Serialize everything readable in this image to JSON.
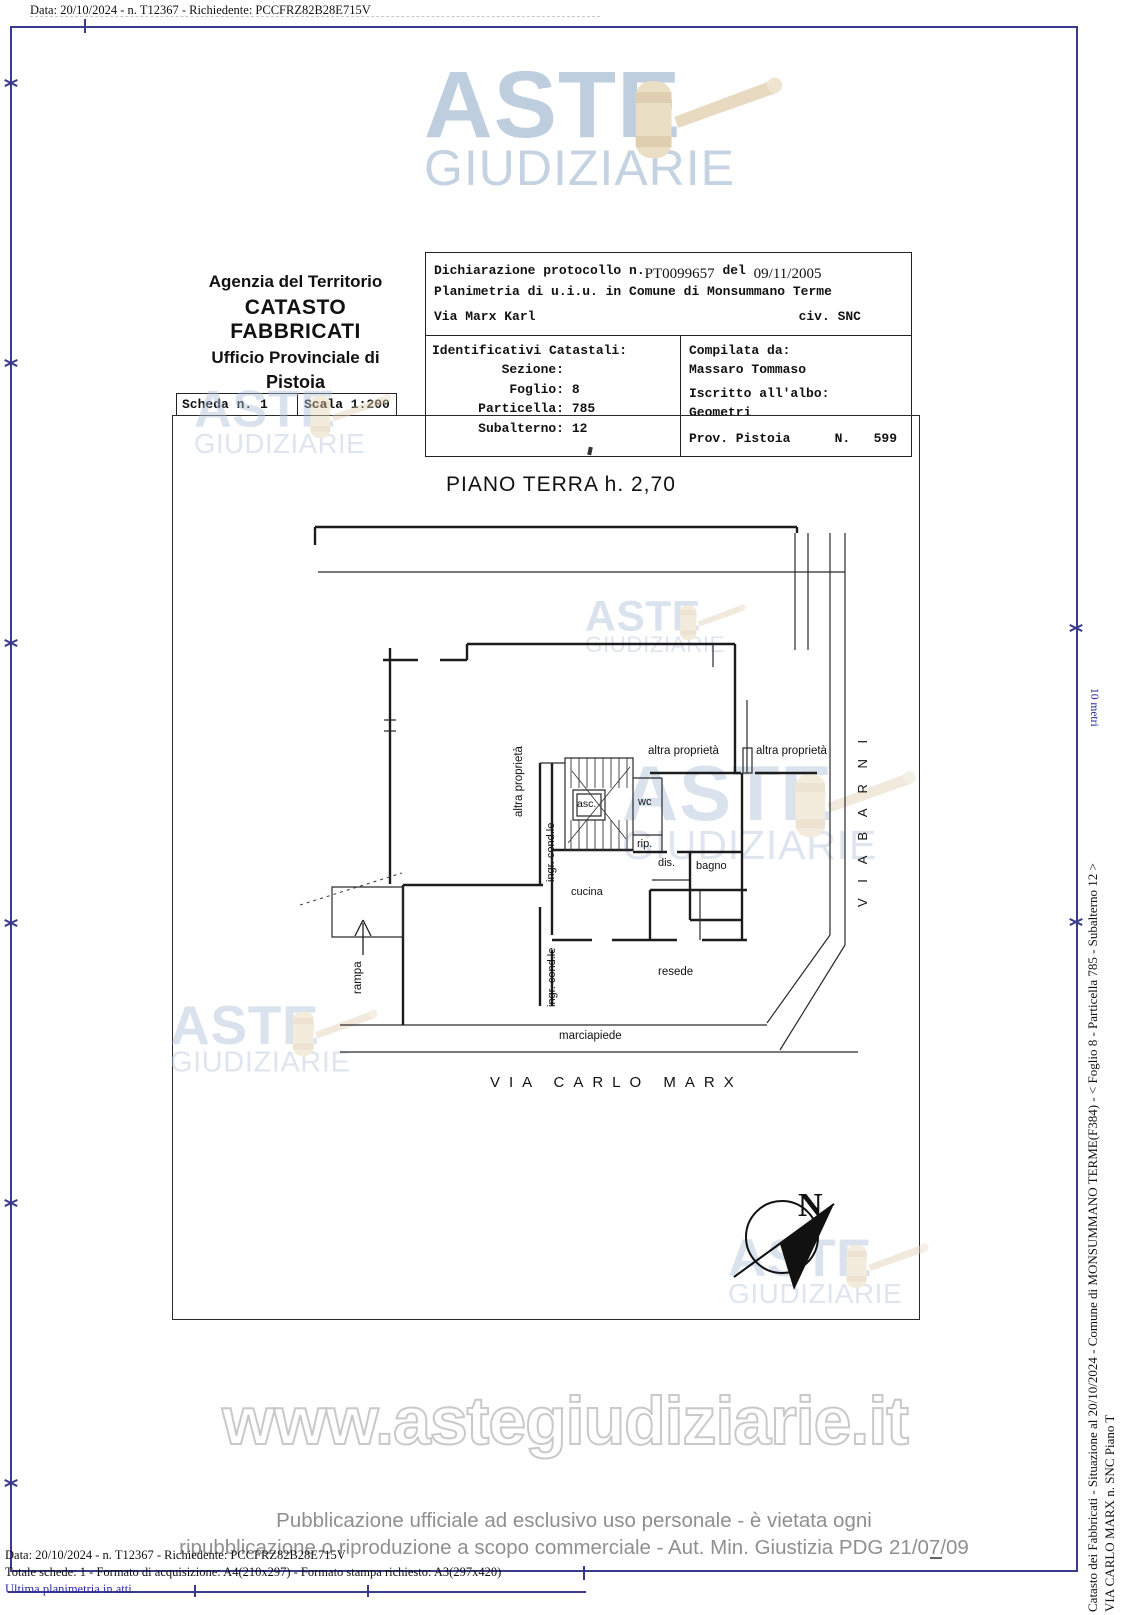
{
  "header": {
    "line": "Data: 20/10/2024 - n. T12367 - Richiedente: PCCFRZ82B28E715V"
  },
  "logo": {
    "word1": "ASTE",
    "word2": "GIUDIZIARIE"
  },
  "agency": {
    "line1": "Agenzia del Territorio",
    "line2": "CATASTO FABBRICATI",
    "line3": "Ufficio Provinciale di",
    "line4": "Pistoia"
  },
  "scheda": {
    "left": "Scheda n. 1",
    "right": "Scala 1:200"
  },
  "declaration": {
    "protocol_label": "Dichiarazione protocollo n.",
    "protocol_number": "PT0099657",
    "del_label": " del ",
    "protocol_date": "09/11/2005",
    "planimetria": "Planimetria di u.i.u. in Comune di Monsummano Terme",
    "street": "Via Marx Karl",
    "civ": "civ. SNC"
  },
  "identificativi": {
    "title": "Identificativi Catastali:",
    "rows": [
      {
        "label": "Sezione:",
        "value": ""
      },
      {
        "label": "Foglio:",
        "value": "8"
      },
      {
        "label": "Particella:",
        "value": "785"
      },
      {
        "label": "Subalterno:",
        "value": "12"
      }
    ]
  },
  "compilata": {
    "title": "Compilata da:",
    "name": "Massaro Tommaso",
    "albo_label": "Iscritto all'albo:",
    "albo_value": "Geometri",
    "prov": "Prov. Pistoia",
    "n_label": "N.",
    "n_value": "599"
  },
  "plan": {
    "title": "PIANO TERRA h. 2,70",
    "labels": {
      "altra_proprieta": "altra proprietà",
      "ingr_condle": "ingr. cond.le",
      "asc": "asc.",
      "wc": "wc",
      "rip": "rip.",
      "dis": "dis.",
      "bagno": "bagno",
      "cucina": "cucina",
      "resede": "resede",
      "marciapiede": "marciapiede",
      "rampa": "rampa"
    },
    "streets": {
      "via_barni": "V I A   B A R N I",
      "via_carlo_marx": "VIA  CARLO  MARX"
    },
    "north_letter": "N",
    "scale_note": "10 metri"
  },
  "watermark_url": "www.astegiudiziarie.it",
  "disclaimer": {
    "line1": "Pubblicazione ufficiale ad esclusivo uso personale - è vietata ogni",
    "line2": "ripubblicazione o riproduzione a scopo commerciale - Aut. Min. Giustizia PDG 21/07/09"
  },
  "footer": {
    "line1": "Data: 20/10/2024 - n. T12367 - Richiedente: PCCFRZ82B28E715V",
    "line2": "Totale schede: 1 - Formato di acquisizione: A4(210x297)  - Formato stampa richiesto: A3(297x420)",
    "line3": "Ultima planimetria in atti"
  },
  "side": {
    "line1": "Catasto dei Fabbricati - Situazione al 20/10/2024 - Comune di MONSUMMANO TERME(F384) - < Foglio 8 - Particella  785 - Subalterno 12 >",
    "line2": "VIA CARLO MARX n. SNC Piano T"
  },
  "colors": {
    "frame_blue": "#3b3b8c",
    "logo_blue": "#aec2d8",
    "gavel_tan": "#e6d6b6",
    "footer_blue": "#2a2aa6",
    "disclaimer_gray": "#8f8f8f"
  }
}
